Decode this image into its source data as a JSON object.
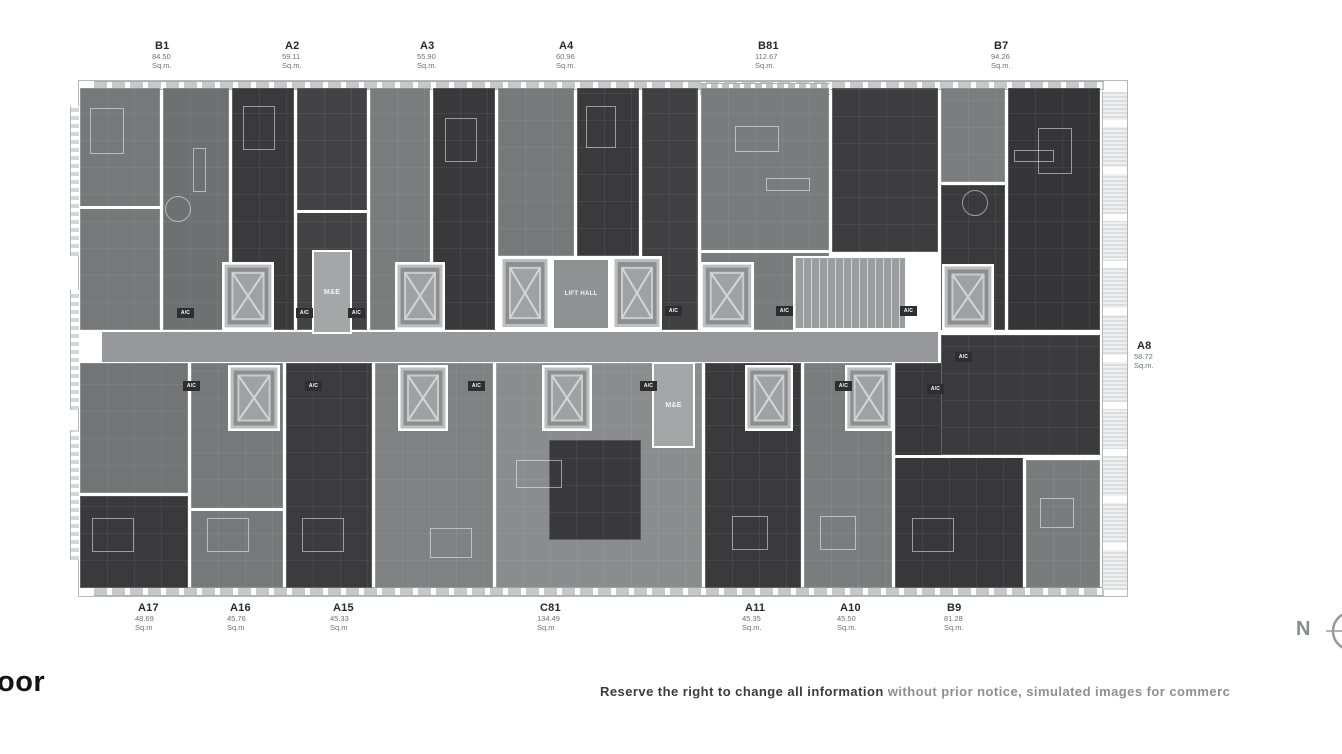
{
  "title_fragment": "oor",
  "disclaimer": {
    "part1": "Reserve the right to change all information",
    "part2": " without prior notice, simulated images for commerc"
  },
  "compass": {
    "label": "N"
  },
  "plan": {
    "ac_label": "A/C",
    "me_label": "M&E",
    "lift_hall_label": "LIFT HALL",
    "units": {
      "top": [
        {
          "name": "B1",
          "area": "84.50",
          "unit": "Sq.m."
        },
        {
          "name": "A2",
          "area": "59.11",
          "unit": "Sq.m."
        },
        {
          "name": "A3",
          "area": "55.90",
          "unit": "Sq.m."
        },
        {
          "name": "A4",
          "area": "60.96",
          "unit": "Sq.m."
        },
        {
          "name": "B81",
          "area": "112.67",
          "unit": "Sq.m."
        },
        {
          "name": "B7",
          "area": "94.26",
          "unit": "Sq.m."
        }
      ],
      "bottom": [
        {
          "name": "A17",
          "area": "48.69",
          "unit": "Sq.m"
        },
        {
          "name": "A16",
          "area": "45.76",
          "unit": "Sq.m"
        },
        {
          "name": "A15",
          "area": "45.33",
          "unit": "Sq.m"
        },
        {
          "name": "C81",
          "area": "134.49",
          "unit": "Sq.m"
        },
        {
          "name": "A11",
          "area": "45.35",
          "unit": "Sq.m."
        },
        {
          "name": "A10",
          "area": "45.50",
          "unit": "Sq.m."
        },
        {
          "name": "B9",
          "area": "81.28",
          "unit": "Sq.m."
        }
      ],
      "right": [
        {
          "name": "A8",
          "area": "58.72",
          "unit": "Sq.m."
        }
      ]
    },
    "colors": {
      "dark_unit": "#3a3a3c",
      "medium_unit": "#77787a",
      "corridor": "#97989b",
      "service_room": "#a4a6a8",
      "walls": "#ffffff"
    }
  }
}
